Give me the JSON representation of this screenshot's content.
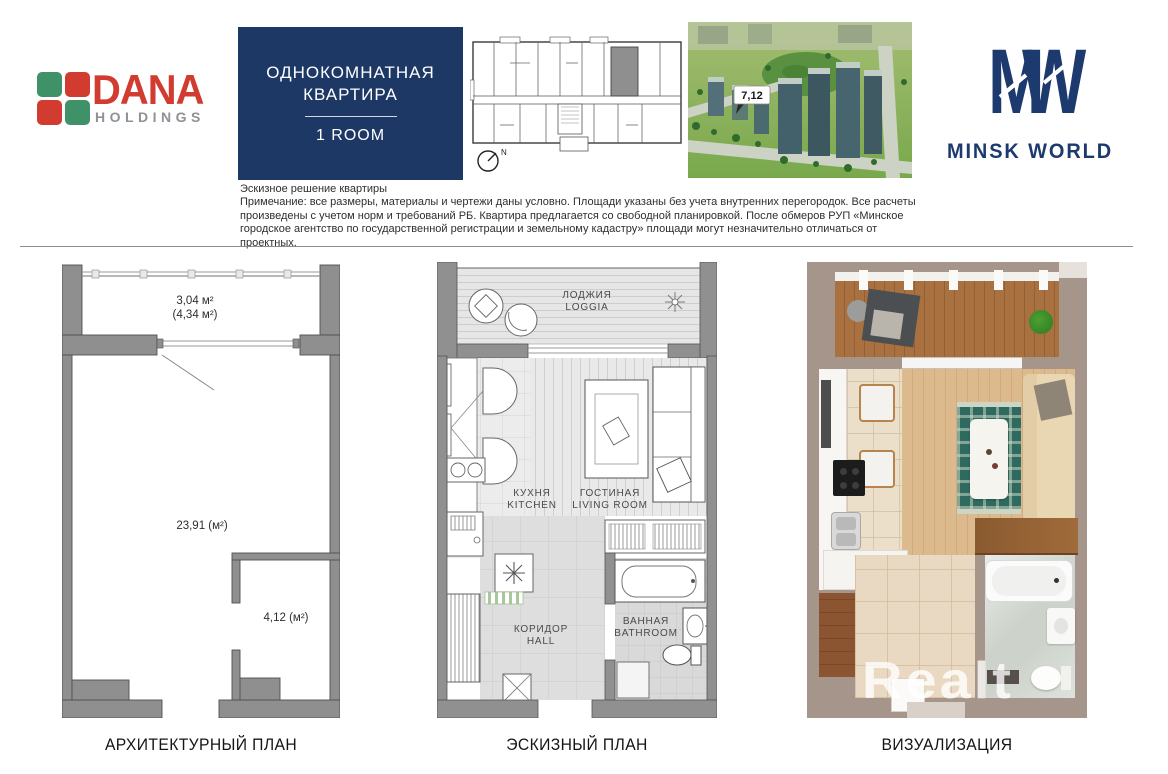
{
  "colors": {
    "navy": "#1d3865",
    "dana_red": "#d23b30",
    "dana_green": "#3f9168",
    "logo_gray": "#8e9296",
    "plan_wall_gray": "#8f8f8f",
    "viz_wall_taupe": "#a5958a"
  },
  "header": {
    "dana": {
      "name": "DANA",
      "subtitle": "HOLDINGS"
    },
    "title_box": {
      "line1": "ОДНОКОМНАТНАЯ",
      "line2": "КВАРТИРА",
      "room_label": "1 ROOM"
    },
    "site_plan": {
      "north": "N"
    },
    "aerial": {
      "building_label": "7,12"
    },
    "minsk_world": {
      "m": "M",
      "w": "W",
      "label": "MINSK WORLD"
    }
  },
  "disclaimer": {
    "title": "Эскизное решение квартиры",
    "note": "Примечание: все размеры, материалы и чертежи даны условно. Площади указаны без учета внутренних перегородок. Все расчеты произведены с учетом норм и требований РБ. Квартира предлагается со свободной планировкой. После обмеров РУП «Минское городское агентство по государственной регистрации и земельному кадастру» площади могут незначительно отличаться от проектных."
  },
  "architectural_plan": {
    "caption": "АРХИТЕКТУРНЫЙ ПЛАН",
    "loggia_area": "3,04 м²",
    "loggia_area_alt": "(4,34 м²)",
    "living_area": "23,91 (м²)",
    "bathroom_area": "4,12 (м²)"
  },
  "sketch_plan": {
    "caption": "ЭСКИЗНЫЙ ПЛАН",
    "loggia": {
      "ru": "ЛОДЖИЯ",
      "en": "LOGGIA"
    },
    "kitchen": {
      "ru": "КУХНЯ",
      "en": "KITCHEN"
    },
    "living": {
      "ru": "ГОСТИНАЯ",
      "en": "LIVING ROOM"
    },
    "bathroom": {
      "ru": "ВАННАЯ",
      "en": "BATHROOM"
    },
    "hall": {
      "ru": "КОРИДОР",
      "en": "HALL"
    }
  },
  "visualization": {
    "caption": "ВИЗУАЛИЗАЦИЯ",
    "watermark": "Realt"
  }
}
